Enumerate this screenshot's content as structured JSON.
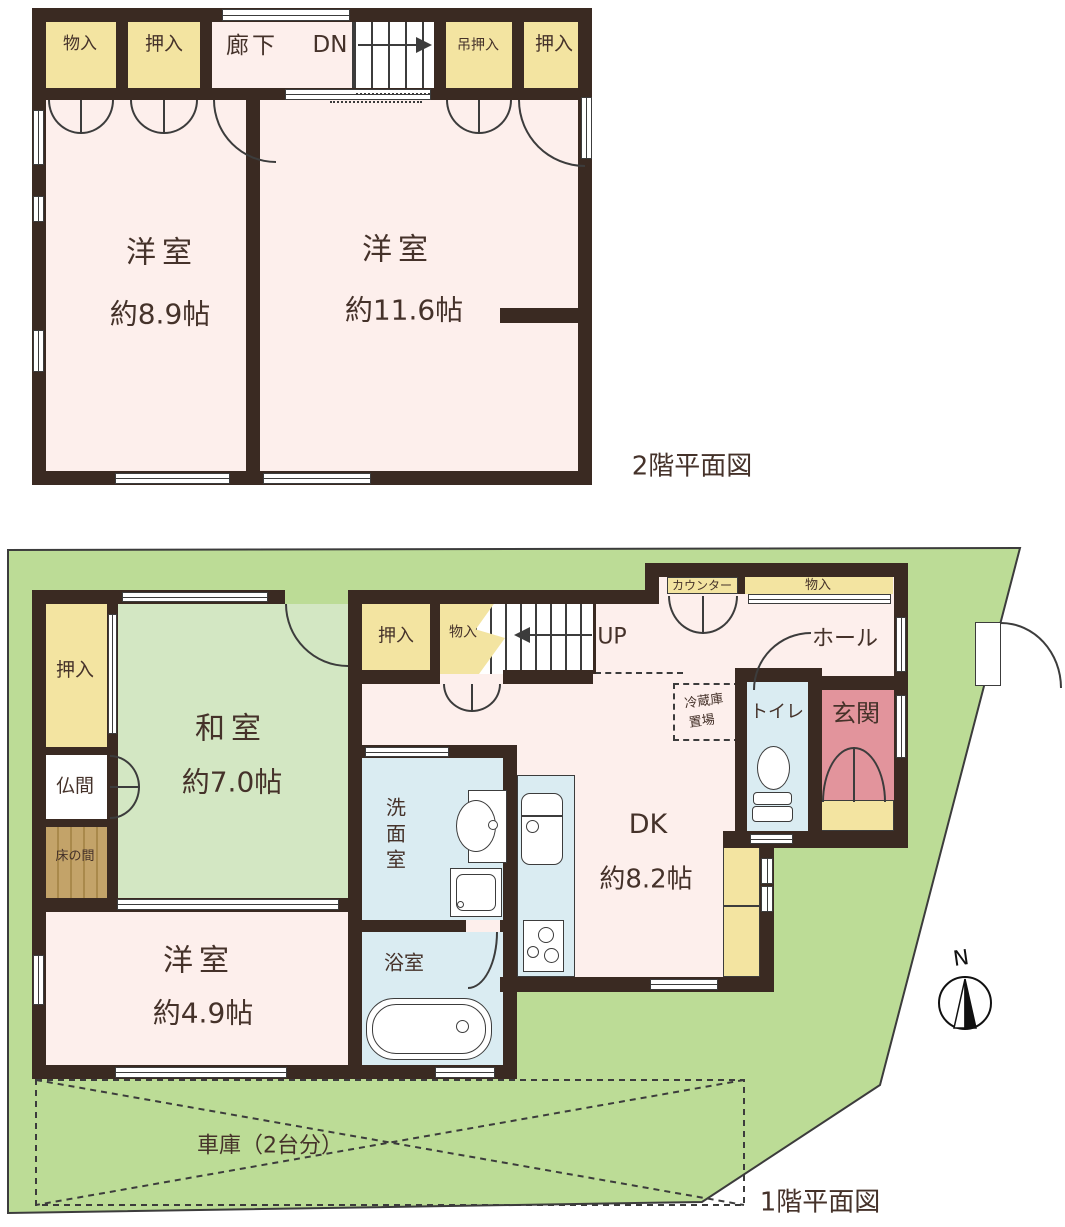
{
  "floor2": {
    "title": "2階平面図",
    "storage1": "物入",
    "closet1": "押入",
    "corridor": "廊下",
    "down": "DN",
    "hanging_closet": "吊押入",
    "closet2": "押入",
    "room1_name": "洋室",
    "room1_size": "約8.9帖",
    "room2_name": "洋室",
    "room2_size": "約11.6帖"
  },
  "floor1": {
    "title": "1階平面図",
    "counter": "カウンター",
    "storage_hall": "物入",
    "hall": "ホール",
    "up": "UP",
    "closet_mid": "押入",
    "storage_mid": "物入",
    "fridge_line1": "冷蔵庫",
    "fridge_line2": "置場",
    "toilet": "トイレ",
    "entrance": "玄関",
    "closet_left": "押入",
    "altar_room": "仏間",
    "alcove": "床の間",
    "washitsu_name": "和室",
    "washitsu_size": "約7.0帖",
    "youshitsu_name": "洋室",
    "youshitsu_size": "約4.9帖",
    "washroom": "洗面室",
    "bathroom": "浴室",
    "dk_name": "DK",
    "dk_size": "約8.2帖",
    "garage": "車庫（2台分）",
    "compass_north": "N"
  },
  "colors": {
    "wall": "#3a2a22",
    "room_pink": "#fdefec",
    "closet_yellow": "#f3e4a1",
    "tatami_green": "#d3e7c3",
    "wet_blue": "#daecf2",
    "entrance_pink": "#e2949c",
    "site_green": "#bcdc96",
    "alcove_brown": "#c3a369",
    "text": "#45322a"
  }
}
